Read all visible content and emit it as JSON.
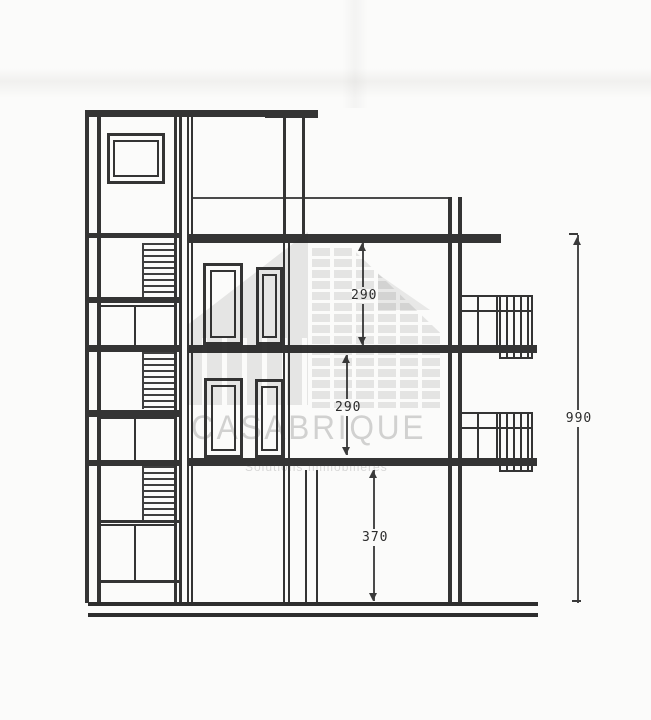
{
  "page": {
    "kind": "Scanned architectural cross-section drawing",
    "watermark": {
      "brand": "CASABRIQUE",
      "tagline": "Solutions Immobilières"
    },
    "dimensions": {
      "floor2_height": "290",
      "floor1_height": "290",
      "ground_height": "370",
      "total_height": "990"
    },
    "colors": {
      "ink": "#343434",
      "paper": "#fbfbfa",
      "watermark_gray": "#e2e2e2"
    }
  }
}
